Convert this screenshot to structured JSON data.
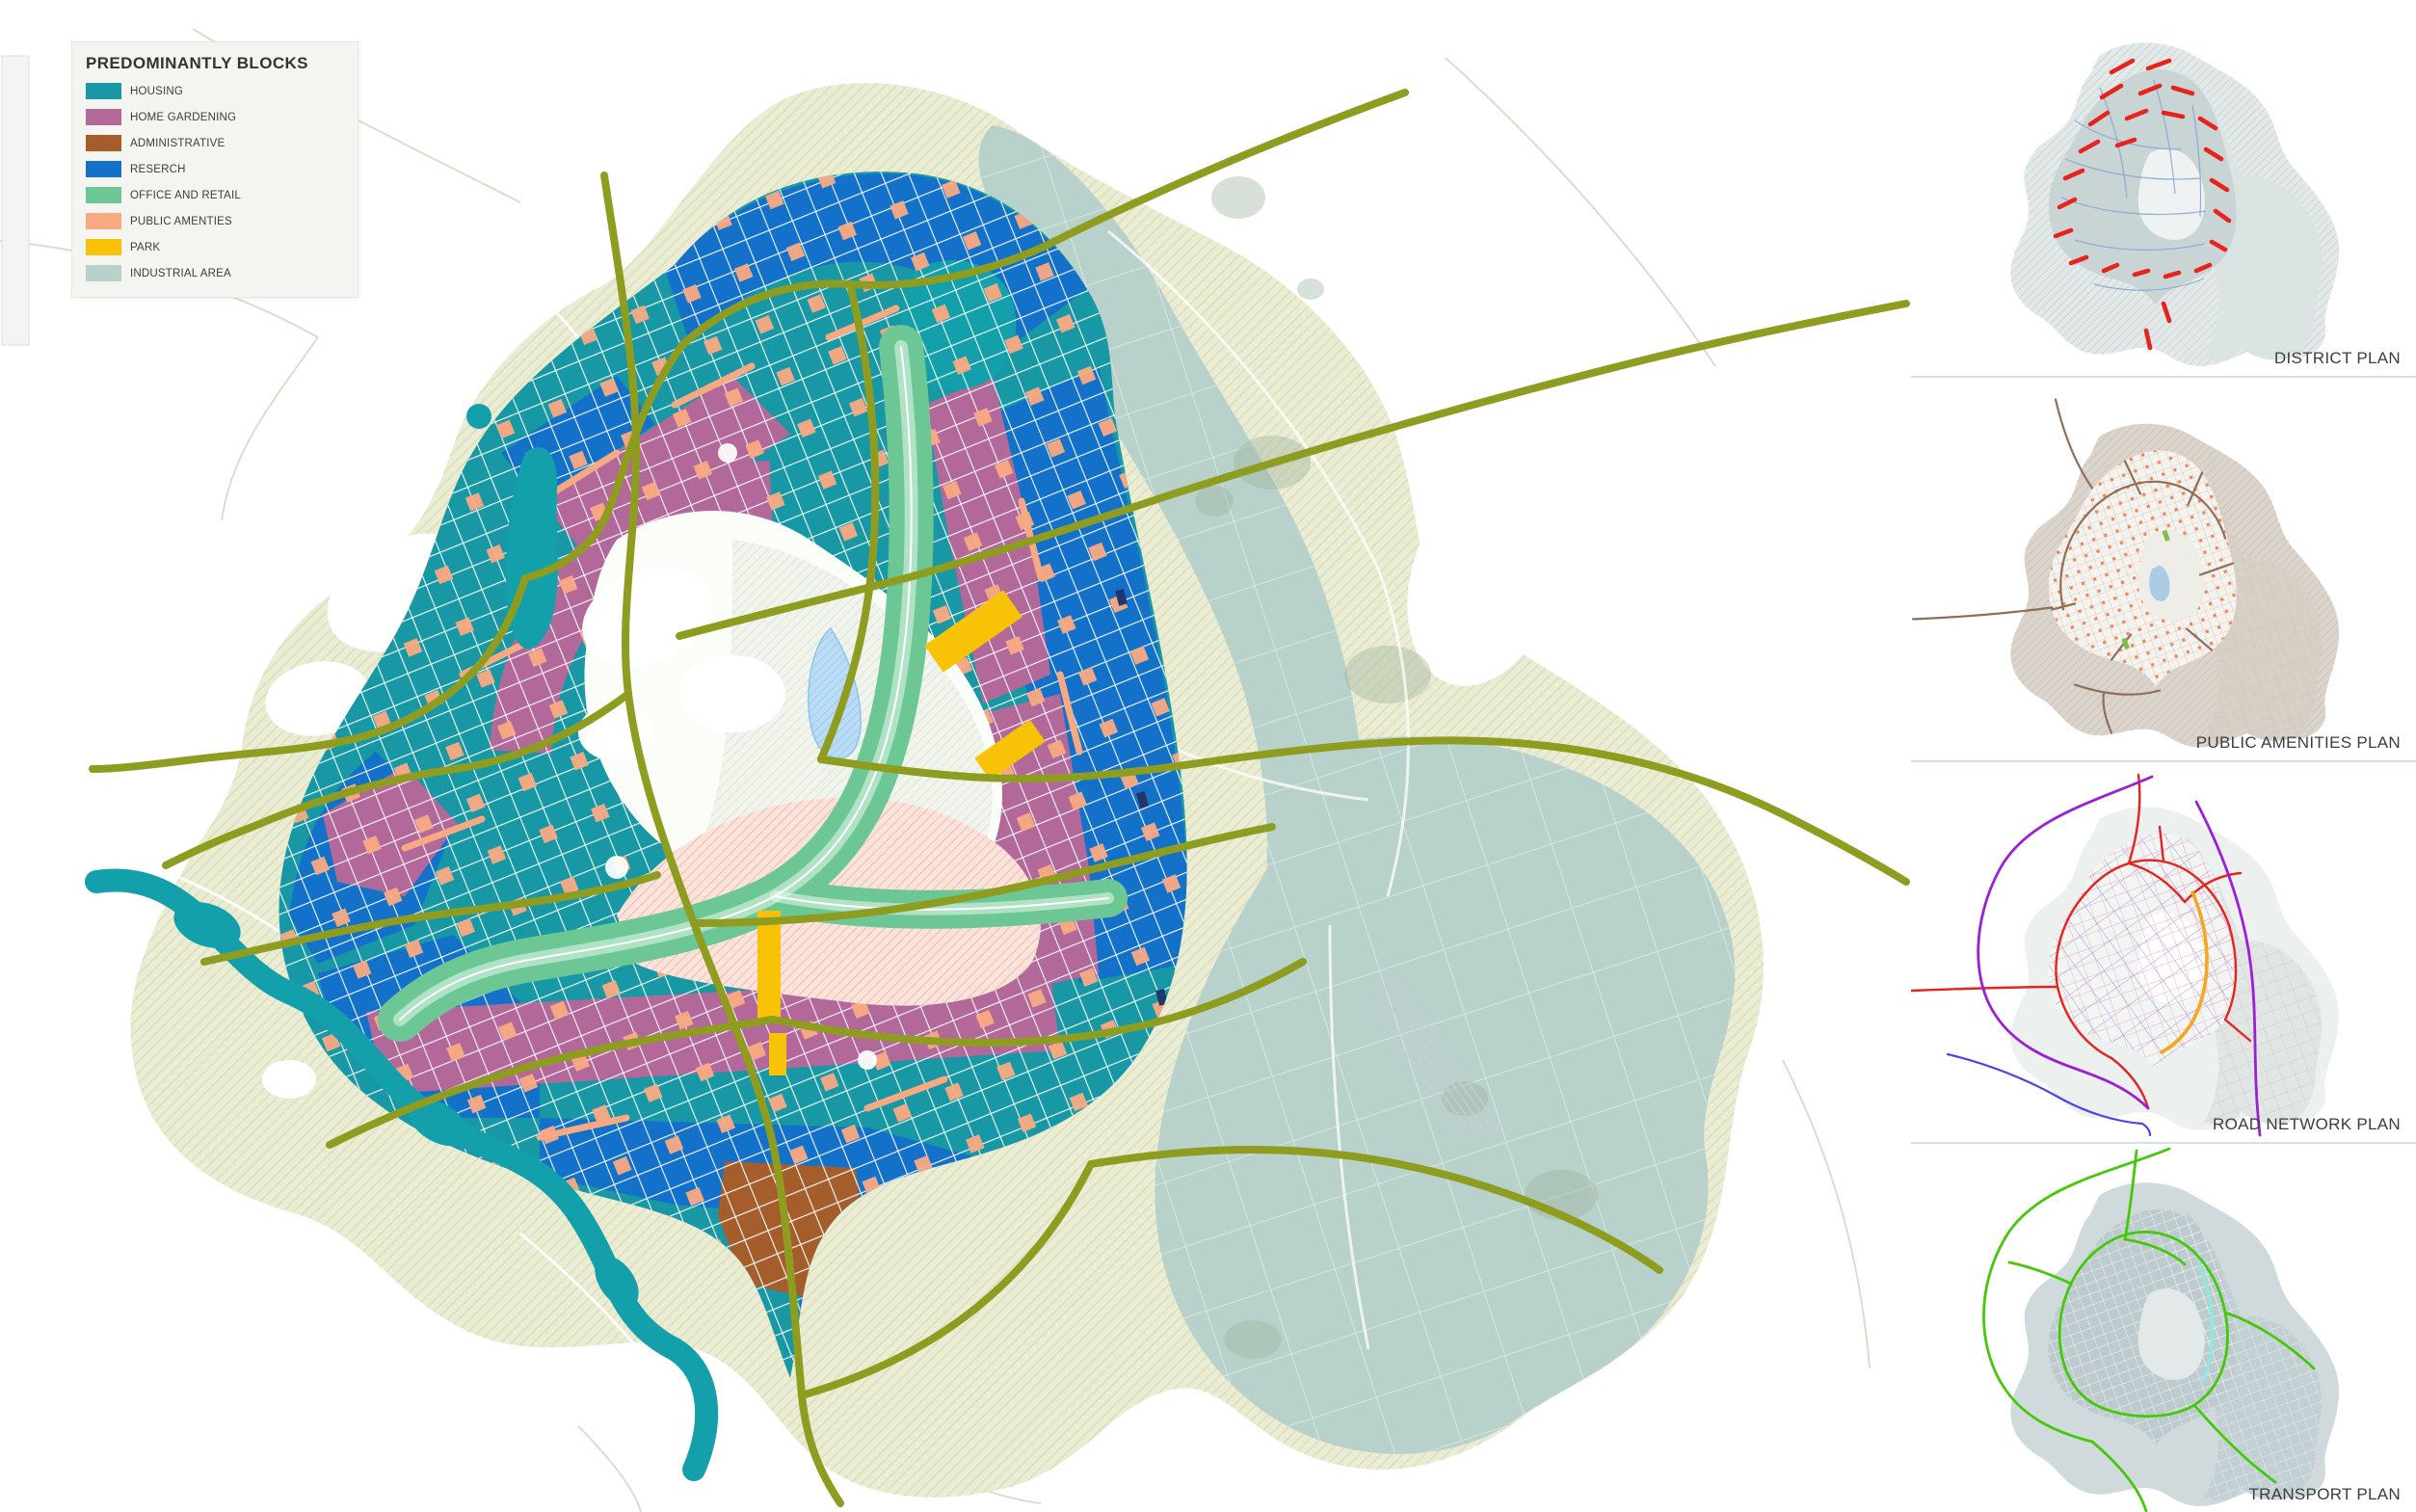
{
  "legend": {
    "title": "PREDOMINANTLY BLOCKS",
    "items": [
      {
        "label": "HOUSING",
        "key": "housing"
      },
      {
        "label": "HOME GARDENING",
        "key": "home_gardening"
      },
      {
        "label": "ADMINISTRATIVE",
        "key": "administrative"
      },
      {
        "label": "RESERCH",
        "key": "research"
      },
      {
        "label": "OFFICE AND RETAIL",
        "key": "office_retail"
      },
      {
        "label": "PUBLIC AMENTIES",
        "key": "public_amenities"
      },
      {
        "label": "PARK",
        "key": "park"
      },
      {
        "label": "INDUSTRIAL AREA",
        "key": "industrial"
      }
    ]
  },
  "panels": [
    {
      "label": "DISTRICT PLAN"
    },
    {
      "label": "PUBLIC AMENITIES PLAN"
    },
    {
      "label": "ROAD NETWORK PLAN"
    },
    {
      "label": "TRANSPORT PLAN"
    }
  ],
  "colors": {
    "housing": "#1898A4",
    "home_gardening": "#B2699A",
    "administrative": "#A65D2C",
    "research": "#1371C9",
    "office_retail": "#6DC795",
    "public_amenities": "#F9A981",
    "park": "#F8C306",
    "industrial": "#B8D2CB",
    "outskirt": "#EAECD3",
    "outskirt_hatch": "#D8DCB6",
    "water": "#14A0AA",
    "road": "#8E9D20",
    "lake": "#BBDCF5",
    "open_area": "#F4F7EF",
    "pink_zone": "#FAE3DB",
    "district_red": "#E8231D",
    "district_line": "#86A8CE",
    "amenities_taupe": "#8F6E5A",
    "road_purple": "#9B1FD4",
    "road_red": "#E8231D",
    "road_pink": "#F2A9BC",
    "road_violet": "#9A7BD8",
    "road_orange": "#F5A81C",
    "road_blue": "#4845EE",
    "transport_green": "#46C80A",
    "transport_cyan": "#8FE9E2",
    "panel_label": "#3D3D3D",
    "separator": "#D6DFE2",
    "legend_bg": "#F4F4F0"
  }
}
